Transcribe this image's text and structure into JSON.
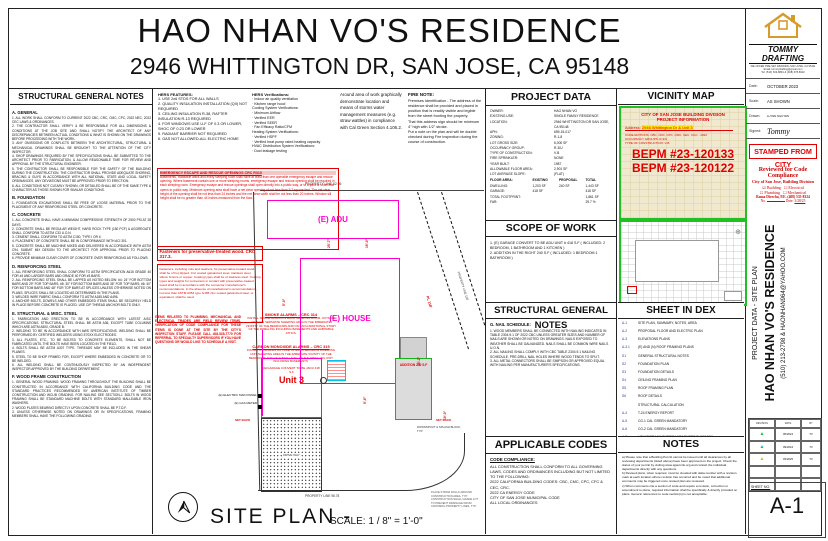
{
  "title": {
    "line1": "HAO NHAN VO'S RESIDENCE",
    "line2": "2946 WHITTINGTON DR, SAN JOSE, CA 95148"
  },
  "left_notes": {
    "header": "STRUCTURAL GENERAL NOTES",
    "sections": [
      {
        "title": "A. GENERAL",
        "body": "1. ALL WORK SHALL CONFORM TO CURRENT 2022 CBC, CRC, CMC, CPC, 2022 NEC, 2022 CEC LAWS & ORDINANCES.\n2. THE CONTRACTOR SHALL VERIFY & BE RESPONSIBLE FOR ALL DIMENSIONS & CONDITIONS AT THE JOB SITE AND SHALL NOTIFY THE ARCHITECT OF ANY DISCREPANCIES BETWEEN ACTUAL CONDITIONS & WHAT IS SHOWN ON THE DRAWINGS BEFORE PROCEEDING WITH THE WORK.\n3. ANY OMISSIONS OR CONFLICTS BETWEEN THE ARCHITECTURAL, STRUCTURAL & MECHANICAL DRAWINGS SHALL BE BROUGHT TO THE ATTENTION OF THE CITY INSPECTOR.\n4. SHOP DRAWINGS REQUIRED BY THE SPECIFICATIONS SHALL BE SUBMITTED TO THE ARCHITECT PRIOR TO FABRICATION, & ALLOW REASONABLE TIME FOR REVIEW AND APPROVAL BY THE STRUCTURAL ENGINEER.\n5. THE CONTRACTOR SHALL BE RESPONSIBLE FOR THE SAFETY OF THE BUILDING DURING THE CONSTRUCTION. THE CONTRACTOR SHALL PROVIDE ADEQUATE SHORING, BRACING & GUYS IN ACCORDANCE WITH ALL NATIONAL, STATE AND LOCAL SAFETY ORDINANCES. ANY DEVIATIONS MUST BE APPROVED PRIOR TO ERECTION.\n6. ALL CONDITIONS NOT CLEARLY SHOWN, OR DETAILED SHALL BE OF THE SAME TYPE & CHARACTER AS THOSE SHOWN FOR SIMILAR CONDITIONS."
      },
      {
        "title": "B. FOUNDATION",
        "body": "1. FOUNDATION EXCAVATIONS SHALL BE FREE OF LOOSE MATERIAL PRIOR TO THE PLACEMENT OF ANY REINFORCING STEEL OR CONCRETE."
      },
      {
        "title": "C. CONCRETE",
        "body": "1. ALL CONCRETE SHALL HAVE A MINIMUM COMPRESSIVE STRENGTH OF 2500 PSI AT 28 DAYS.\n2. CONCRETE SHALL BE REGULAR WEIGHT, HARD ROCK TYPE (150 PCF) & AGGREGATE SHALL CONFORM TO ASTM C33 U.O.N.\n3. CEMENT SHALL CONFORM TO ASTM C150, TYPE I OR II.\n4. PLACEMENT OF CONCRETE SHALL BE IN CONFORMANCE WITH ACI 301.\n5. CONCRETE SHALL BE MACHINE MIXED AND DELIVERED IN ACCORDANCE WITH ASTM C94. SUBMIT MIX DESIGN TO THE ARCHITECT FOR APPROVAL PRIOR TO PLACING CONCRETE.\n6. PROVIDE MINIMUM CLEAR COVER OF CONCRETE OVER REINFORCING AS FOLLOWS:"
      },
      {
        "title": "D. REINFORCING STEEL",
        "body": "1. ALL REINFORCING STEEL SHALL CONFORM TO ASTM SPECIFICATION A615 GRADE 40 FOR #4 AND LARGER BARS AND GRADE 40 FOR #3 BARS.\n2. ALL REINFORCING STEEL SHALL BE LAPPED AS NOTED BELOW: #4: 24\" FOR BOTTOM BARS AND 29\" FOR TOP BARS; #5: 30\" FOR BOTTOM BARS AND 36\" FOR TOP BARS; #6: 40\" FOR BOTTOM BARS AND 48\" FOR TOP BARS AT SPLICES UNLESS OTHERWISE NOTED ON PLANS. SPLICES SHALL BE LOCATED AS DETERMINED IN THE PLANS.\n3. WELDED WIRE FABRIC SHALL CONFORM TO ASTM A185 AND A496.\n4. ANCHOR BOLTS, DOWELS AND OTHER EMBEDDED ITEMS SHALL BE SECURELY HELD IN PLACE BEFORE CONCRETE IS PLACED. USE CIP THREAD ANCHOR BOLTS ONLY."
      },
      {
        "title": "E. STRUCTURAL & MISC. STEEL",
        "body": "1. FABRICATION AND ERECTION TO BE IN ACCORDANCE WITH LATEST AISC SPECIFICATIONS. STRUCTURAL STEEL SHALL BE ASTM A36, EXCEPT TUBE COLUMNS WHICH ARE ASTM A500, GRADE B.\n2. WELDING TO BE IN ACCORDANCE WITH AWS SPECIFICATIONS. WELDING SHALL BE PERFORMED BY CERTIFIED WELDERS USING E70XX ELECTRODES.\n3. ALL PLATES, ETC., TO BE BOLTED TO CONCRETE ELEMENTS, SHALL NOT BE FABRICATED UNTIL THE BOLTS HAVE BEEN LOCATED IN THE FIELD.\n4. BOLTS SHALL BE ASTM A307 TYPE. THREADS MAY BE INCLUDED IN THE SHEAR PLANES.\n5. STEEL TO BE SHOP PRIMED FOR, EXCEPT WHERE EMBEDDED IN CONCRETE OR TO BE WELDED.\n6. ALL WELDING SHALL BE CONTINUOUSLY INSPECTED BY AN INDEPENDENT INSPECTOR APPROVED BY THE BUILDING DEPARTMENT."
      },
      {
        "title": "F. WOOD FRAME CONSTRUCTION",
        "body": "1. GENERAL WOOD FRAMING: WOOD FRAMING THROUGHOUT THE BUILDING SHALL BE CONSTRUCTED IN ACCORDANCE WITH CALIFORNIA BUILDING CODE AND THE STANDARD PRACTICES RECOMMENDED BY AMERICAN INSTITUTE OF TIMBER CONSTRUCTION AND WCLIB GRADING. FOR NAILING SEE SECTION-J. BOLTS IN WOOD FRAMING SHALL BE STANDARD MACHINE BOLTS WITH STANDARD MALLEABLE IRON WASHERS.\n2. WOOD PLATES BEARING DIRECTLY UPON CONCRETE SHALL BE P.T.D.F.\n3. UNLESS OTHERWISE NOTED ON DRAWINGS OR IN SPECIFICATIONS, FRAMING MEMBERS SHALL HAVE THE FOLLOWING GRADING:"
      }
    ]
  },
  "hers": {
    "features_title": "HERS FEATURES:",
    "features": "1. USE 2x6 STDS FOR ALL WALLS\n2. QUALITY INSULATION INSTALLATION (QII) NOT REQUIRED\n3. CEILING INSULATION R-38, RAFTER INSULATION R-13 REQUIRED\n4. FOR WINDOWS USE U-F OF 0.3 OR LOWER, SHGC OF 0.23 OR LOWER\n5. RADIANT BARRIER NOT REQUIRED\n6. GAS NOT ALLOWED-ALL ELECTRIC HOME",
    "verifications_title": "HERS Verifications:",
    "verifications": "· Indoor air quality ventilation\n· Kitchen range hood\nCooling System Verifications:\n· Minimum Airflow\n· Verified EER\n· Verified SEER\n· Fan Efficacy Ratio/CFM\nHeating System Verifications:\n· Verified HSPF\n· Verified heat pump rated heating capacity\nHVAC Distribution System Verifications:\n· Duct leakage testing"
  },
  "storm_note": "Around area of work graphically demonstrate location and means of storms water management measures (e.g. straw wattles) in compliance with Cal Green Section 4.106.2.",
  "fire_note": {
    "title": "FIRE NOTE:",
    "body": "Premises Identification - The address of the residence shall be provided and placed in position that is readily visible and legible from the street fronting the property.\nThat this address sign should be minimum 4\" high with 1/2\" stroke.\nPut a note on the plan and will be double checked during Fire inspection during the course of construction."
  },
  "project_data": {
    "header": "PROJECT DATA",
    "rows": [
      {
        "l": "OWNER:",
        "v": "HAO NHAN VO"
      },
      {
        "l": "EXISTING USE:",
        "v": "SINGLE FAMILY RESIDENCE"
      },
      {
        "l": "LOCATION:",
        "v": "2946 WHITTINGTON DR SAN JOSE, CA 95148"
      },
      {
        "l": "APN:",
        "v": "659-15-017"
      },
      {
        "l": "ZONING:",
        "v": "R-1-8"
      },
      {
        "l": "LOT GROSS SIZE:",
        "v": "6,000 SF"
      },
      {
        "l": "OCCUPANCY GROUP:",
        "v": "R-3/U"
      },
      {
        "l": "TYPE OF CONSTRUCTION:",
        "v": "V-B"
      },
      {
        "l": "FIRE SPRINKLER:",
        "v": "NONE"
      },
      {
        "l": "YEAR BUILT:",
        "v": "1987"
      },
      {
        "l": "ALLOWABLE FLOOR AREA:",
        "v": "2,901 SF"
      },
      {
        "l": "LOT AVERAGE SLOPE:",
        "v": "(FLAT)"
      }
    ],
    "fa_label": "FLOOR AREA:",
    "fa_cols": {
      "a": "EXISTING",
      "b": "PROPOSAL",
      "c": "TOTAL"
    },
    "fa_rows": [
      {
        "l": "DWELLING:",
        "a": "1,203 SF",
        "b": "240 SF",
        "c": "1,443 SF"
      },
      {
        "l": "GARAGE:",
        "a": "418 SF",
        "b": "",
        "c": "418 SF"
      },
      {
        "l": "TOTAL FOOTPRINT:",
        "a": "",
        "b": "",
        "c": "1,861 SF"
      },
      {
        "l": "FAR:",
        "a": "",
        "b": "",
        "c": "29.7 %"
      }
    ]
  },
  "scope": {
    "header": "SCOPE OF WORK",
    "body": "1. (E) GARAGE CONVERT TO BE ADU UNIT # 418 S.F ( INCLUDED: 2 BEDROOM, 1 BATHROOM AND 1 KITCHEN )\n2. ADDITION IN THE RIGHT 240 S.F ( INCLUDED: 1 BEDROOM 1 BATHROOM )"
  },
  "structural_right": {
    "header": "STRUCTURAL GENERAL NOTES",
    "sub": "G. NAIL SCHEDULE:",
    "body": "1. WOOD MEMBERS SHALL BE CONNECTED WITH NAILING INDICATED IN TABLE 2304.9.1 OF 2022 CBC UNLESS GREATER SIZES AND NUMBER OF NAILS ARE SHOWN OR NOTED ON DRAWINGS. NAILS EXPOSED TO WEATHER SHALL BE GALVANIZED. NAILS SHALL BE COMMON WIRE NAILS U.O.N.\n2. ALL NAILING SHALL COMPLY WITH CBC TABLE 2304.9.1 NAILING SCHEDULE. PRE-DRILL NAIL HOLES WHERE WOOD TENDS TO SPLIT.\n3. ALL METAL CONNECTORS SHALL BE SIMPSON OR APPROVED EQUAL WITH NAILING PER MANUFACTURER'S SPECIFICATIONS."
  },
  "codes": {
    "header": "APPLICABLE CODES",
    "sub": "CODE COMPLIANCE:",
    "body": "ALL CONSTRUCTION SHALL CONFORM TO ALL GOVERNING LAWS, CODES AND ORDINANCES INCLUDING BUT NOT LIMITED TO THE FOLLOWING:\n2022 CALIFORNIA BUILDING CODES: CBC, CMC, CPC, CFC & CEC, CRC.\n2022 CA ENERGY CODE\nCITY OF SAN JOSE MUNICIPAL CODE\nALL LOCAL ORDINANCES"
  },
  "vicinity": {
    "header": "VICINITY MAP",
    "line1": "CITY OF SAN JOSE BUILDING DIVISION",
    "line2": "PROJECT INFORMATION",
    "addr_label": "Address:",
    "addr_value": "2946 Whittington Dr",
    "addr_unit": "& Unit 3",
    "line4": "CODE EDITIONS: CBC, CRC, CPC, CMC, CEC, CGC - 2022",
    "line5": "OCCUPANCY GROUPS: R-3/U",
    "line6": "TYPE OF CONSTRUCTION: V-B",
    "bepm1": "BEPM #23-120133",
    "bepm2": "BEPM #23-120122"
  },
  "sheet_index": {
    "header": "SHEET IN DEX",
    "rows": [
      {
        "no": "A-1",
        "t": "SITE PLAN, SUMMARY, NOTES, AREA"
      },
      {
        "no": "A-2",
        "t": "PROPOSAL FLOOR AND ELECTRIC PLAN"
      },
      {
        "no": "A-3",
        "t": "ELEVATIONS PLANS"
      },
      {
        "no": "A-3.1",
        "t": "(E) AND (N) ROOF FRAMING PLANS"
      },
      {
        "no": "S1",
        "t": "GENERAL STRUCTURAL NOTES"
      },
      {
        "no": "S2",
        "t": "FOUNDATION PLAN"
      },
      {
        "no": "S3",
        "t": "FOUNDATION DETAILS"
      },
      {
        "no": "S4",
        "t": "CEILING FRAMING PLAN"
      },
      {
        "no": "S5",
        "t": "ROOF FRAMING PLAN"
      },
      {
        "no": "S6",
        "t": "ROOF DETAILS"
      },
      {
        "no": "",
        "t": "STRUCTURAL CALCULATION"
      },
      {
        "no": "A-4",
        "t": "T-24 ENERGY REPORT"
      },
      {
        "no": "A-5",
        "t": "CG-1 CAL GREEN MANDATORY"
      },
      {
        "no": "A-6",
        "t": "CG-2 CAL GREEN MANDATORY"
      },
      {
        "no": "A-7",
        "t": "LOW-RISE MANDATORY MEASURES SUMMARY"
      }
    ]
  },
  "notes_col": {
    "header": "NOTES",
    "body": "a) Please note that a Building Permit cannot be issued until all clearances by all reviewing departments (listed above) have been approved on the project. Check the status of your permit by visiting www.sjpermits.org and contact the individual departments directly with any questions.\nb) Revised plans, when required, must be clouded with delta number with a revision mark at each location where revision has occurred and be noted that additional comments may be triggered once revised plan are reviewed.\nc) When comments cite a section of code and require a revision, correction or amendment to plans, required information shall be specifically & directly provided on plans. Generic references to code section(s) is not acceptable."
  },
  "plan": {
    "property_line_top": "PROPERTY LINE 62.96",
    "property_line_bottom": "PROPERTY LINE 98.78",
    "property_line_right": "PROPERTY LINE 118'",
    "pl_right_short": "PL 118'",
    "adu_label": "(E) ADU",
    "house_label": "(E) HOUSE",
    "garage_note": "(E)GARAGE CONVERT TO BE JADU 418 S.F",
    "unit_label": "Unit 3",
    "electric_label": "(E) ELECTRIC MAIN PANEL",
    "gas_label": "(E) GAS METER",
    "driveway_label": "DRIVE WAY",
    "addition_label": "ADDITION 240 S.F",
    "setback_label": "SET BACK",
    "downspout_label": "DOWNSPOUT & SPLASH BLOCK, TYP.",
    "straw_note": "PLACE STRAW ROLLS AROUND CONSTRUCTION AREA, TYP. CONSTRUCTION SHALL GRADE LOT TO PREVENT DRAINAGE FROM CROSSING PROPERTY LINES, TYP.",
    "dims": [
      "25'-7\"",
      "19'-0\"",
      "5'-0\"",
      "15'-2\"",
      "10'-0\"",
      "5'-6\""
    ],
    "emergency": {
      "title": "EMERGENCY ESCAPE AND RESCUE OPENINGS CRC R310",
      "body": "Basements, Habitable attics and every sleeping room shall have at least than one operable emergency escape and rescue opening. Where basement contain one or more sleeping rooms, emergency escape and rescue opening shall be required in each sleeping room. Emergency escape and rescue openings shall open directly into a public way, or to a yard or court that opens to public way. Minimum opening area shall have a net clear opening of not less than 5.7 square feet. The net clear height of the opening shall be not less than 24 inches and the net clear width shall be not less than 20 inches. Window sill height shall be no greater than 44 inches measured from the floor."
    },
    "fasteners": {
      "title": "Fasteners for preservative-treated wood. CRC 317.3.",
      "body": "Fasteners, including nuts and washers, for preservative-treated wood shall be of hot dipped, zinc coated galvanized steel, stainless steel, silicon bronze or copper. Coating types shall be of stainless steel. Coating types and weights for connectors in contact with preservative-treated wood shall be in accordance with the connector manufacturer's recommendations. In the absence of manufacturer's recommendations, not less than ASTM A653 type G185 zinc coated galvanized steel, or equivalent, shall be used."
    },
    "trades_note": "ITEMS RELATED TO PLUMBING, MECHANICAL AND ELECTRICAL TRADES ARE FIELD REVIEW ITEMS. VERIFICATION OF CODE COMPLIANCE FOR THESE ITEMS IS DONE AT THE SITE BY THE CITY'S INSPECTION STAFF. PLEASE CALL 408-535-7770 FOR REFERRAL TO SPECIALTY SUPERVISORS IF YOU HAVE QUESTIONS OR WOULD LIKE TO SCHEDULE A VISIT.",
    "smoke": {
      "title": "SMOKE ALARMS – CRC 314",
      "body": "INSTALL SMOKE ALARMS IN EACH SLEEPING ROOM, OUTSIDE OF EACH SEPARATE SLEEPING AREA IN THE IMMEDIATE VICINITY OF THE BEDROOMS AND ON EACH ADDITIONAL STORY OF THE DWELLING INCLUDING BASEMENTS AND HABITABLE ATTICS."
    },
    "co": {
      "title": "CARBON MONOXIDE ALARMS – CRC 315",
      "body": "INSTALL CM ALARMS OUTSIDE OF EACH SEPARATE DWELLING UNIT SLEEPING AREA IN THE IMMEDIATE VICINITY OF THE BEDROOMS AND ON EVERY LEVEL OF THE DWELLING UNIT INCLUDING BASEMENTS."
    },
    "title": "SITE  PLAN -",
    "scale": "SCALE: 1 / 8\" = 1'-0\""
  },
  "titleblock": {
    "brand": "TOMMY DRAFTING",
    "tagline": "WE OFFER PRE-SET DRAWING SAN JOSE, CA 95111",
    "email": "Email: tommydrafting@gmail.com",
    "tel": "Tel: (510) 633-8891 & (408) 678-8622",
    "date_label": "Date:",
    "date": "OCTOBER 2023",
    "scale_label": "Scale:",
    "scale": "AS SHOWN",
    "drawn_label": "Drawn:",
    "drawn": "LUYEN NGUYEN",
    "signed_label": "Signed:",
    "signed": "Tommy",
    "stamp": "STAMPED FROM CITY",
    "reviewed": {
      "title": "Reviewed for Code Compliance",
      "line2": "City of San Jose, Building Division",
      "check1": "☑ Building",
      "check2": "☐ Electrical",
      "check3": "☐ Plumbing",
      "check4": "☐ Mechanical",
      "name": "Rama Divecha, P.E. (408) 535-8324",
      "no_label": "No.",
      "date_label": "Date:",
      "date": "3/28/25"
    },
    "vertical1": "PROJECT DATA - SITE PLAN",
    "vertical2": "HAO NHAN VO'S RESIDENCE",
    "vertical3": "(510) 213-2798 & HAONHAN964@YAHOO.COM",
    "rev_headers": {
      "c1": "REVISION",
      "c2": "DATE",
      "c3": "BY"
    },
    "rev_rows": [
      {
        "tri": "▲",
        "date": "05/2024",
        "by": "TV"
      },
      {
        "tri": "▲",
        "date": "09/2024",
        "by": "TV"
      },
      {
        "tri": "▲",
        "date": "03/2025",
        "by": "TV"
      }
    ],
    "sheet_no_label": "SHEET NO.",
    "sheet_no": "A-1"
  }
}
